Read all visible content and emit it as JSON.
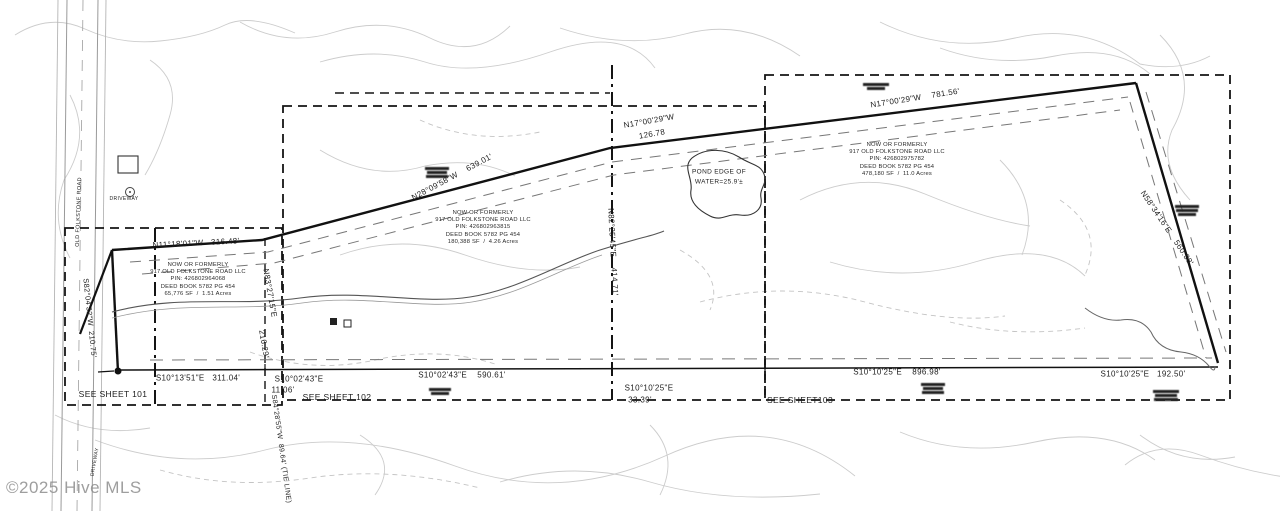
{
  "watermark": "©2025 Hive MLS",
  "palette": {
    "ink": "#1a1a1a",
    "faint_contour": "#cccccc",
    "road_gray": "#b5b5b5",
    "paper": "#ffffff",
    "watermark_gray": "#8e8e8e"
  },
  "labels": [
    {
      "name": "bearing-label",
      "text": "N17°00'29\"W",
      "x": 649,
      "y": 121,
      "rot": -10,
      "size": 8
    },
    {
      "name": "distance-label",
      "text": "126.78",
      "x": 652,
      "y": 134,
      "rot": -10,
      "size": 8
    },
    {
      "name": "bearing-label",
      "text": "N17°00'29\"W    781.56'",
      "x": 915,
      "y": 98,
      "rot": -9,
      "size": 8
    },
    {
      "name": "bearing-label",
      "text": "N28°09'58\"W    639.01'",
      "x": 452,
      "y": 177,
      "rot": -28,
      "size": 8
    },
    {
      "name": "bearing-label",
      "text": "N11°18'01\"W   316.48'",
      "x": 196,
      "y": 243,
      "rot": -3,
      "size": 8
    },
    {
      "name": "bearing-label",
      "text": "S82°04'32\"W  210.75'",
      "x": 90,
      "y": 318,
      "rot": 84,
      "size": 7.5
    },
    {
      "name": "bearing-label",
      "text": "N83°27'15\"E",
      "x": 270,
      "y": 293,
      "rot": 80,
      "size": 8
    },
    {
      "name": "distance-label",
      "text": "216.29'",
      "x": 264,
      "y": 344,
      "rot": 80,
      "size": 8
    },
    {
      "name": "bearing-label",
      "text": "N82°25'45\"E    414.71'",
      "x": 613,
      "y": 252,
      "rot": 87,
      "size": 8
    },
    {
      "name": "bearing-label",
      "text": "N58°34'16\"E    560.38'",
      "x": 1167,
      "y": 228,
      "rot": 56,
      "size": 8
    },
    {
      "name": "bearing-label",
      "text": "S10°13'51\"E   311.04'",
      "x": 198,
      "y": 378,
      "rot": 0,
      "size": 8
    },
    {
      "name": "bearing-label",
      "text": "S10°02'43\"E",
      "x": 299,
      "y": 379,
      "rot": 0,
      "size": 8
    },
    {
      "name": "distance-label",
      "text": "11.06'",
      "x": 283,
      "y": 390,
      "rot": 0,
      "size": 8
    },
    {
      "name": "bearing-label",
      "text": "S10°02'43\"E    590.61'",
      "x": 462,
      "y": 375,
      "rot": 0,
      "size": 8
    },
    {
      "name": "bearing-label",
      "text": "S10°10'25\"E",
      "x": 649,
      "y": 388,
      "rot": 0,
      "size": 8
    },
    {
      "name": "distance-label",
      "text": "33.39'",
      "x": 640,
      "y": 400,
      "rot": 0,
      "size": 8
    },
    {
      "name": "bearing-label",
      "text": "S10°10'25\"E    896.98'",
      "x": 897,
      "y": 372,
      "rot": 0,
      "size": 8
    },
    {
      "name": "bearing-label",
      "text": "S10°10'25\"E   192.50'",
      "x": 1143,
      "y": 374,
      "rot": 0,
      "size": 8
    },
    {
      "name": "tie-line-label",
      "text": "S84°28'55\"W  89.64' (TIE LINE)",
      "x": 281,
      "y": 449,
      "rot": 82,
      "size": 7
    },
    {
      "name": "sheet-ref-label",
      "text": "SEE SHEET 101",
      "x": 113,
      "y": 394,
      "rot": 0,
      "size": 8.5
    },
    {
      "name": "sheet-ref-label",
      "text": "SEE SHEET 102",
      "x": 337,
      "y": 397,
      "rot": 0,
      "size": 8.5
    },
    {
      "name": "sheet-ref-label",
      "text": "SEE SHEET103",
      "x": 800,
      "y": 400,
      "rot": 0,
      "size": 8.5
    },
    {
      "name": "pond-label",
      "text": "POND EDGE OF",
      "x": 719,
      "y": 172,
      "rot": 0,
      "size": 6.5
    },
    {
      "name": "pond-label",
      "text": "WATER=25.9'±",
      "x": 719,
      "y": 182,
      "rot": 0,
      "size": 6.5
    },
    {
      "name": "road-label",
      "text": "OLD FOLKSTONE ROAD",
      "x": 79,
      "y": 212,
      "rot": -88,
      "size": 5.5
    },
    {
      "name": "driveway-label",
      "text": "DRIVEWAY",
      "x": 124,
      "y": 199,
      "rot": 0,
      "size": 5
    },
    {
      "name": "driveway-label",
      "text": "DRIVEWAY",
      "x": 95,
      "y": 462,
      "rot": -80,
      "size": 5
    }
  ],
  "parcel_blocks": [
    {
      "x": 198,
      "y": 262,
      "lines": [
        "NOW OR FORMERLY",
        "917 OLD FOLKSTONE ROAD LLC",
        "PIN: 426802964068",
        "DEED BOOK 5782 PG 454",
        "65,776 SF  /  1.51 Acres"
      ]
    },
    {
      "x": 483,
      "y": 210,
      "lines": [
        "NOW OR FORMERLY",
        "917 OLD FOLKSTONE ROAD LLC",
        "PIN: 426802963815",
        "DEED BOOK 5782 PG 454",
        "180,388 SF  /  4.26 Acres"
      ]
    },
    {
      "x": 897,
      "y": 142,
      "lines": [
        "NOW OR FORMERLY",
        "917 OLD FOLKSTONE ROAD LLC",
        "PIN: 426802975782",
        "DEED BOOK 5782 PG 454",
        "478,180 SF  /  11.0 Acres"
      ]
    }
  ]
}
